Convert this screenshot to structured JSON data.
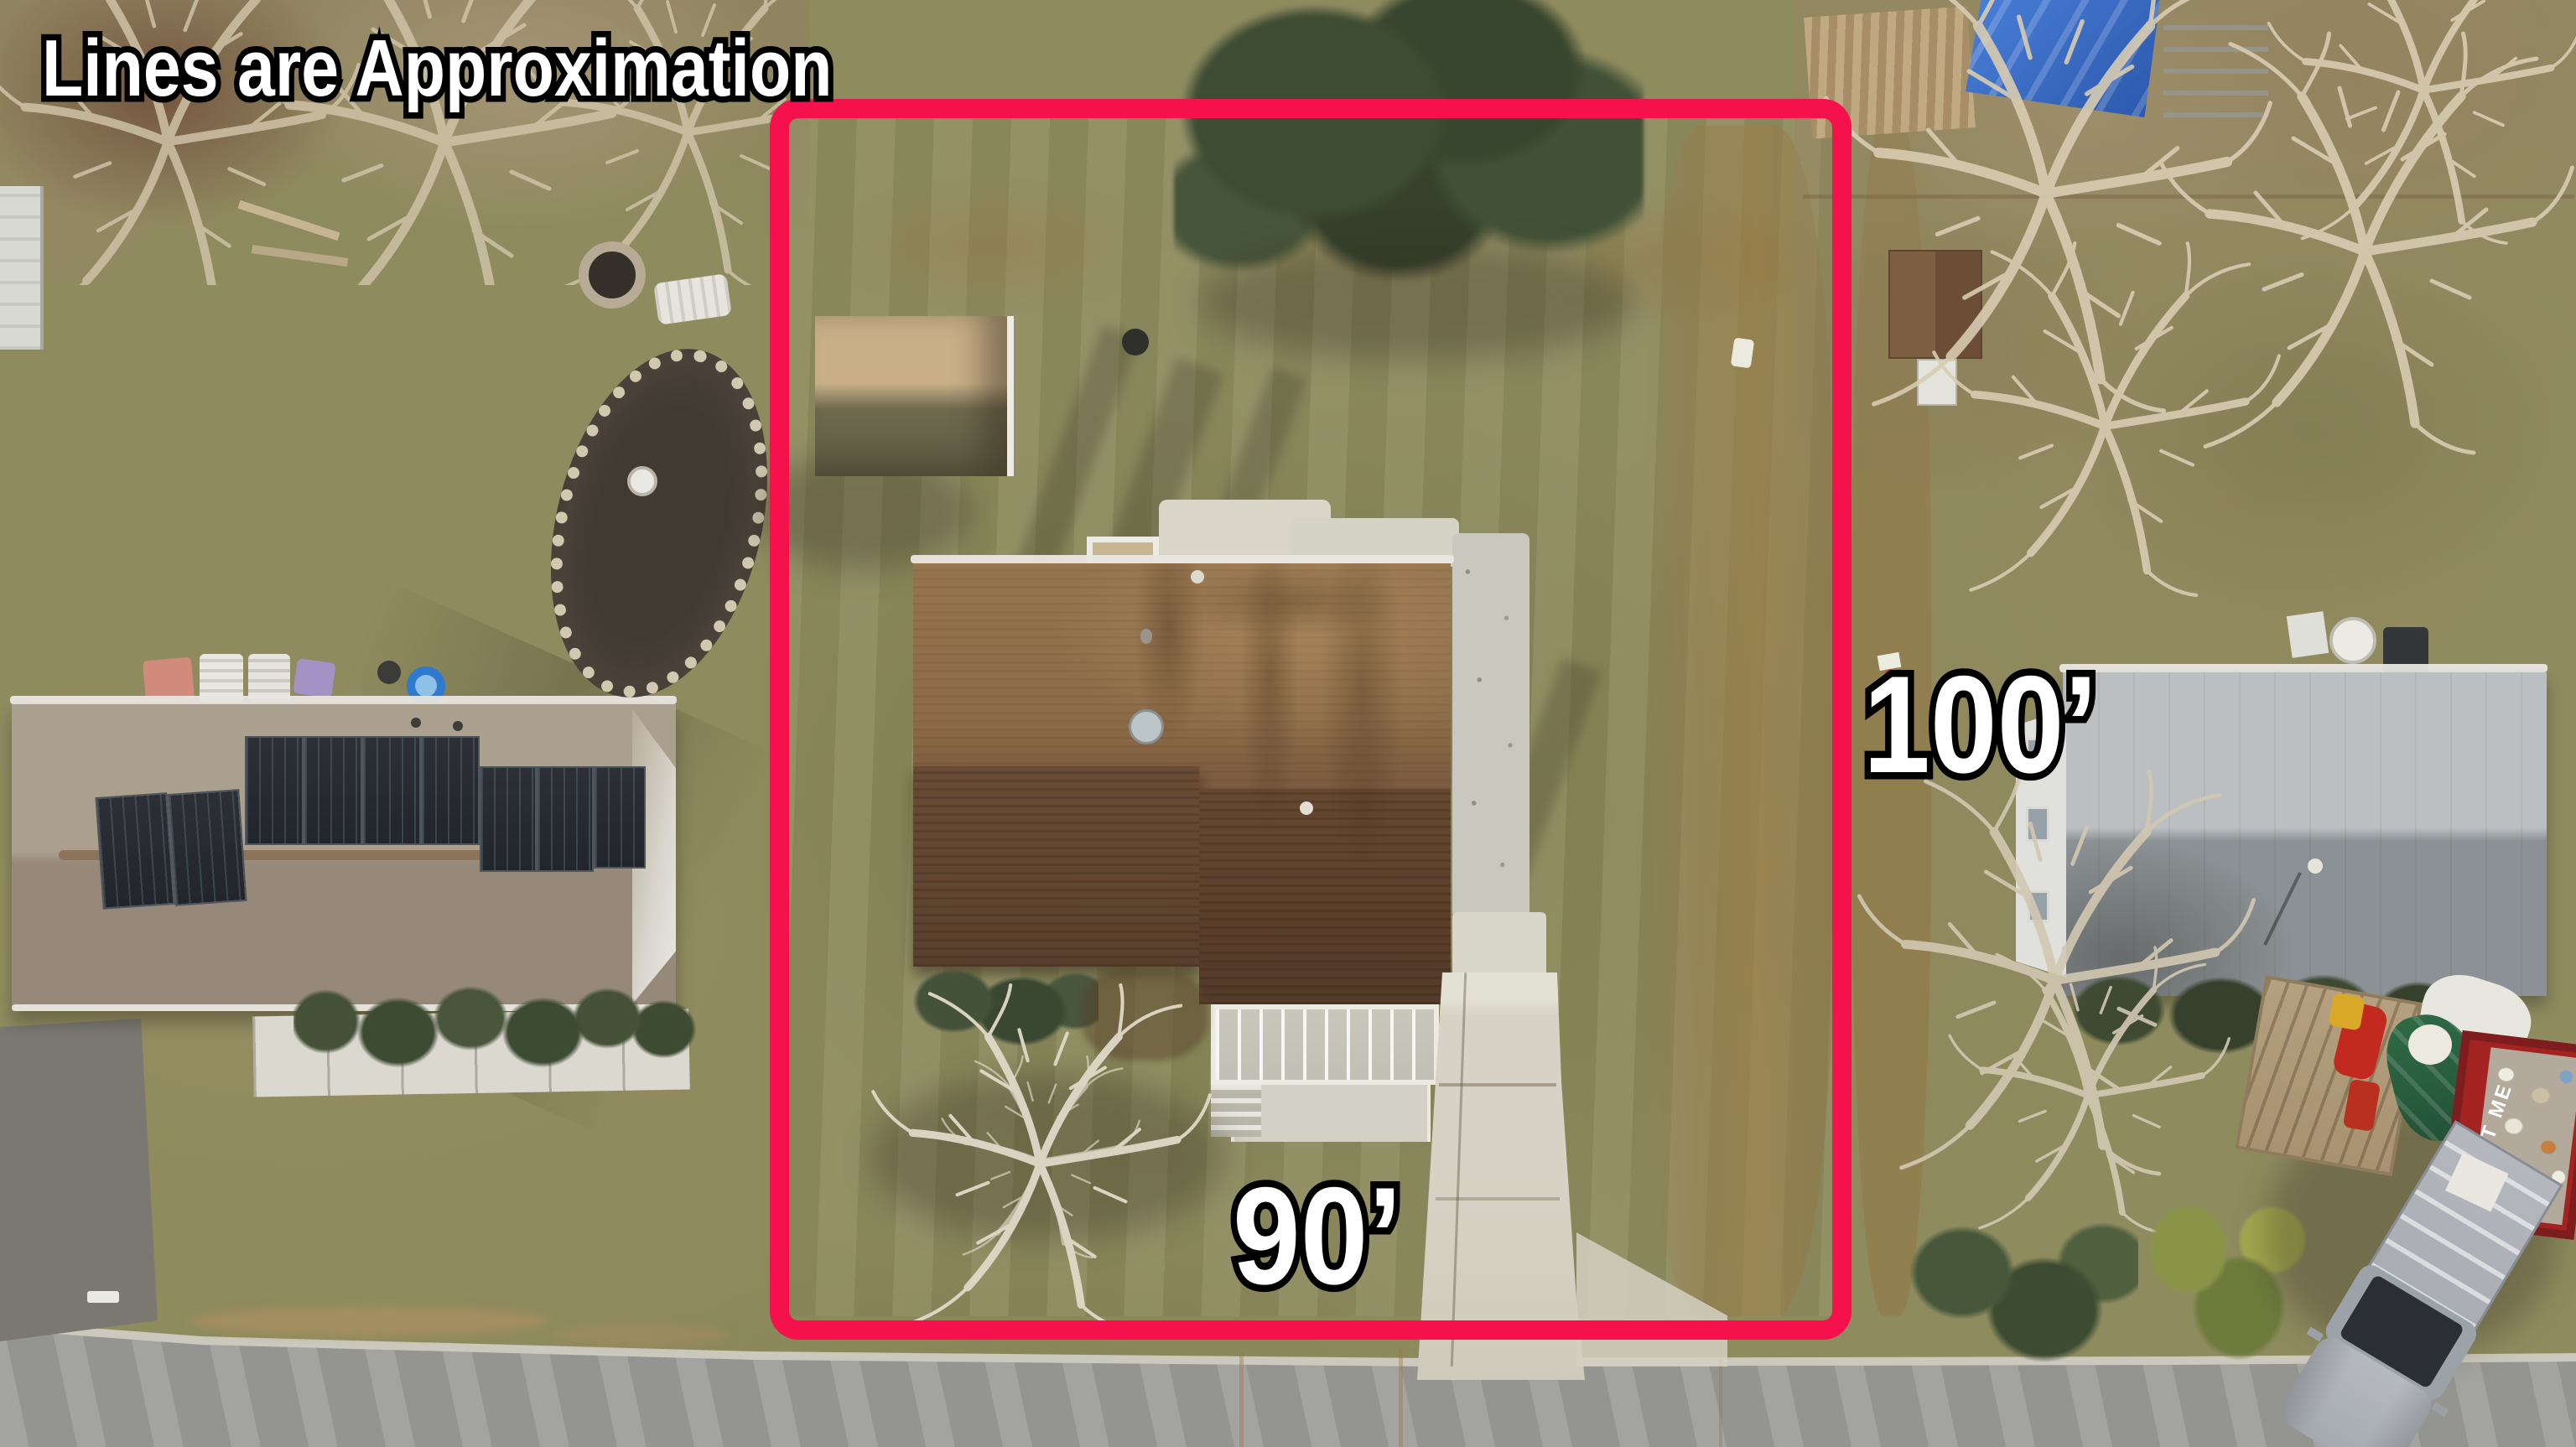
{
  "annotations": {
    "disclaimer": "Lines are Approximation",
    "depth_label": "100’",
    "frontage_label": "90’"
  },
  "objects": {
    "dumpster_text": "RENT ME"
  },
  "palette": {
    "boundary_red": "#F5114B",
    "label_fill": "#FFFFFF",
    "label_outline": "#000000",
    "lawn_olive": "#8E8B5F",
    "road_gray": "#9C9C98",
    "subject_roof_light": "#96744F",
    "subject_roof_dark": "#5E432E",
    "left_roof_taupe": "#A89C8B",
    "right_roof_gray": "#B9BCBE",
    "solar_panel": "#282C33",
    "conifer_green": "#3E4C33",
    "blue_tarp": "#3F74D2"
  }
}
